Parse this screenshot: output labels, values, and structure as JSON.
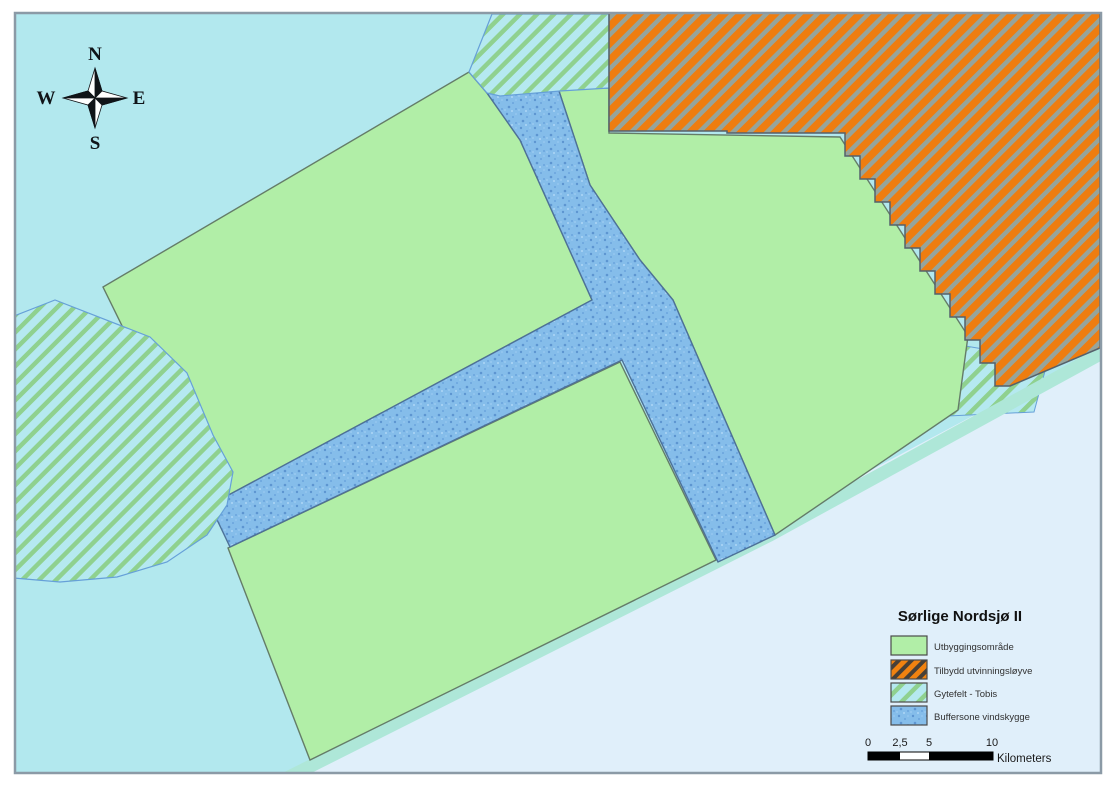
{
  "map": {
    "region_title": "Sørlige Nordsjø II",
    "compass": {
      "n": "N",
      "w": "W",
      "e": "E",
      "s": "S"
    },
    "legend": {
      "title": "Sørlige Nordsjø II",
      "items": [
        {
          "label": "Utbyggingsområde",
          "swatch": "solid-green-swatch",
          "color": "#b1eea7"
        },
        {
          "label": "Tilbydd utvinningsløyve",
          "swatch": "orange-hatch-swatch",
          "color": "#ee7d10"
        },
        {
          "label": "Gytefelt - Tobis",
          "swatch": "green-hatch-on-cyan-swatch",
          "color": "#8fd18f"
        },
        {
          "label": "Buffersone vindskygge",
          "swatch": "blue-stipple-swatch",
          "color": "#85bdea"
        }
      ]
    },
    "scalebar": {
      "ticks": [
        "0",
        "2,5",
        "5",
        "10"
      ],
      "unit": "Kilometers"
    },
    "colors": {
      "water_north": "#b2e8ee",
      "outer_sea_southeast": "#e0effa",
      "shore_strip": "#aee7d8",
      "development_area_green": "#b1eea7",
      "license_area_orange": "#ee7d10",
      "buffer_zone_blue": "#85bdea",
      "spawning_hatch_green": "#8fd18f",
      "map_border": "#8b9aa6"
    }
  }
}
